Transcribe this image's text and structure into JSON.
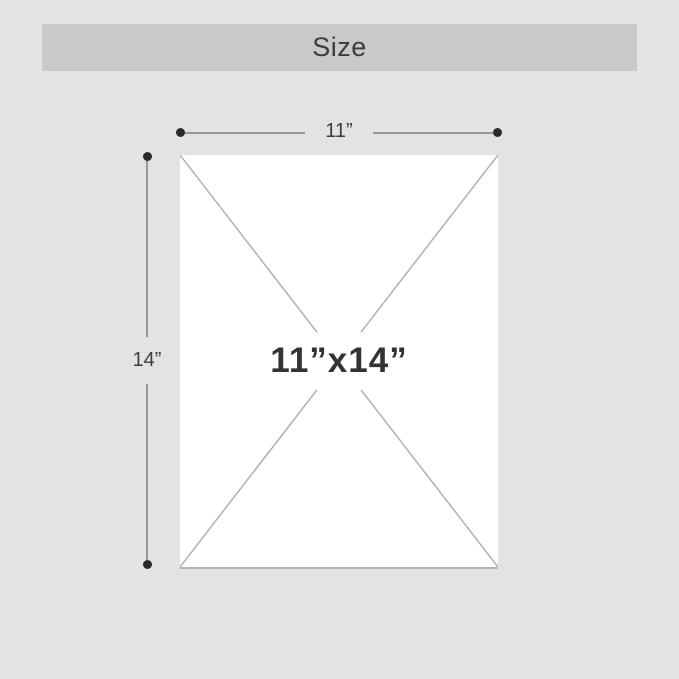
{
  "header": {
    "title": "Size"
  },
  "diagram": {
    "width_label": "11”",
    "height_label": "14”",
    "size_label": "11”x14”"
  },
  "colors": {
    "page_background": "#e3e3e3",
    "header_bar": "#c9c9c9",
    "title_text": "#3c3c3c",
    "dimension_line": "#969696",
    "dimension_dot": "#2b2b2b",
    "sheet_fill": "#ffffff",
    "sheet_bottom_edge": "#b5b5b5",
    "diagonal_line": "#ababab",
    "size_text": "#333333"
  }
}
